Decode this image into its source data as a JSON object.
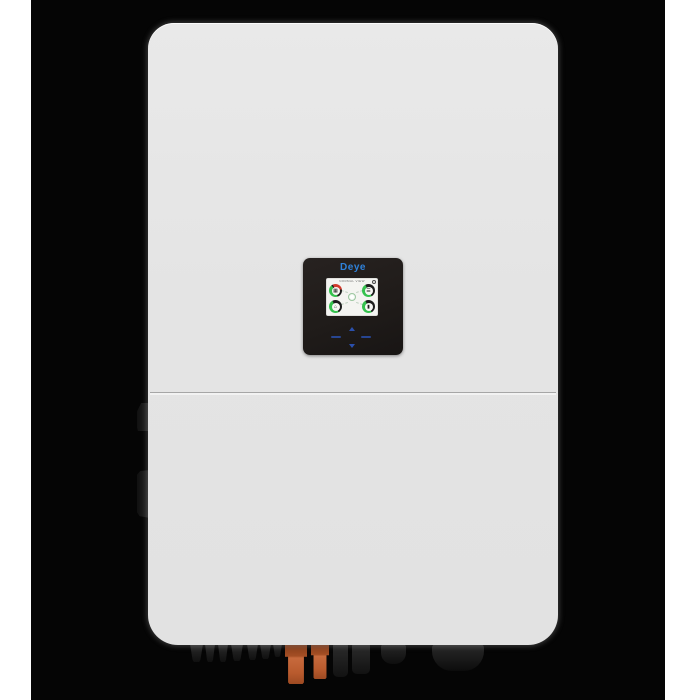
{
  "scene": {
    "canvas_bg": "#ffffff",
    "photo_bg": "#050505"
  },
  "device": {
    "label": "Deye hybrid solar inverter",
    "body_color": "#e4e4e4",
    "seam_color": "#a6a6a6",
    "panel": {
      "bg_color": "#1f1b19",
      "brand": "Deye",
      "brand_color": "#2f82da",
      "screen": {
        "bg_color": "#f4f4f1",
        "title": "NORMAL VIEW",
        "gear_icon": "settings-gear",
        "center_node": "power-flow-hub",
        "gauges": [
          {
            "id": "pv-gauge",
            "corner": "tl",
            "icon_glyph": "▦",
            "segments": [
              {
                "c": "#d23a2c",
                "a": [
                  0,
                  80
                ]
              },
              {
                "c": "#1d1d1d",
                "a": [
                  80,
                  160
                ]
              },
              {
                "c": "#35c14e",
                "a": [
                  160,
                  320
                ]
              },
              {
                "c": "#1d1d1d",
                "a": [
                  320,
                  335
                ]
              },
              {
                "c": "#d23a2c",
                "a": [
                  335,
                  360
                ]
              }
            ]
          },
          {
            "id": "grid-gauge",
            "corner": "tr",
            "icon_glyph": "☰",
            "segments": [
              {
                "c": "#1d1d1d",
                "a": [
                  0,
                  150
                ]
              },
              {
                "c": "#35c14e",
                "a": [
                  150,
                  330
                ]
              },
              {
                "c": "#1d1d1d",
                "a": [
                  330,
                  360
                ]
              }
            ]
          },
          {
            "id": "load-gauge",
            "corner": "bl",
            "icon_glyph": "⌂",
            "segments": [
              {
                "c": "#1d1d1d",
                "a": [
                  0,
                  150
                ]
              },
              {
                "c": "#35c14e",
                "a": [
                  150,
                  330
                ]
              },
              {
                "c": "#1d1d1d",
                "a": [
                  330,
                  360
                ]
              }
            ]
          },
          {
            "id": "battery-gauge",
            "corner": "br",
            "icon_glyph": "▮",
            "segments": [
              {
                "c": "#1d1d1d",
                "a": [
                  0,
                  150
                ]
              },
              {
                "c": "#35c14e",
                "a": [
                  150,
                  330
                ]
              },
              {
                "c": "#1d1d1d",
                "a": [
                  330,
                  360
                ]
              }
            ]
          }
        ]
      },
      "nav_buttons": [
        {
          "id": "nav-up",
          "glyph": "up-arrow"
        },
        {
          "id": "nav-left",
          "glyph": "left-key"
        },
        {
          "id": "nav-right",
          "glyph": "right-key"
        },
        {
          "id": "nav-down",
          "glyph": "down-arrow"
        }
      ],
      "nav_color": "#2e5ed2"
    },
    "side_tabs": [
      {
        "id": "upper-left-tab"
      },
      {
        "id": "lower-left-tab"
      }
    ],
    "connectors": [
      {
        "id": "com-gland-1",
        "kind": "stub",
        "x": 159,
        "w": 13,
        "h": 18
      },
      {
        "id": "com-gland-2",
        "kind": "stub",
        "x": 174,
        "w": 10,
        "h": 18
      },
      {
        "id": "com-gland-3",
        "kind": "stub",
        "x": 187,
        "w": 10,
        "h": 18
      },
      {
        "id": "com-gland-4",
        "kind": "stub",
        "x": 200,
        "w": 12,
        "h": 17
      },
      {
        "id": "com-gland-5",
        "kind": "stub",
        "x": 216,
        "w": 11,
        "h": 16
      },
      {
        "id": "com-gland-6",
        "kind": "stub",
        "x": 229,
        "w": 11,
        "h": 15
      },
      {
        "id": "com-gland-7",
        "kind": "stub",
        "x": 242,
        "w": 9,
        "h": 13
      },
      {
        "id": "battery-terminal-1",
        "kind": "orange",
        "x": 254,
        "w": 22,
        "h": 40,
        "color": "#b95b2e"
      },
      {
        "id": "battery-terminal-2",
        "kind": "orange",
        "x": 280,
        "w": 18,
        "h": 35,
        "color": "#b95b2e"
      },
      {
        "id": "dc-plug-1",
        "kind": "plug",
        "x": 302,
        "w": 15,
        "h": 33
      },
      {
        "id": "dc-plug-2",
        "kind": "plug",
        "x": 321,
        "w": 18,
        "h": 30
      },
      {
        "id": "ac-gland-small",
        "kind": "dome",
        "x": 350,
        "w": 25,
        "h": 20
      },
      {
        "id": "ac-gland-large",
        "kind": "dome-large",
        "x": 401,
        "w": 52,
        "h": 27
      }
    ]
  }
}
